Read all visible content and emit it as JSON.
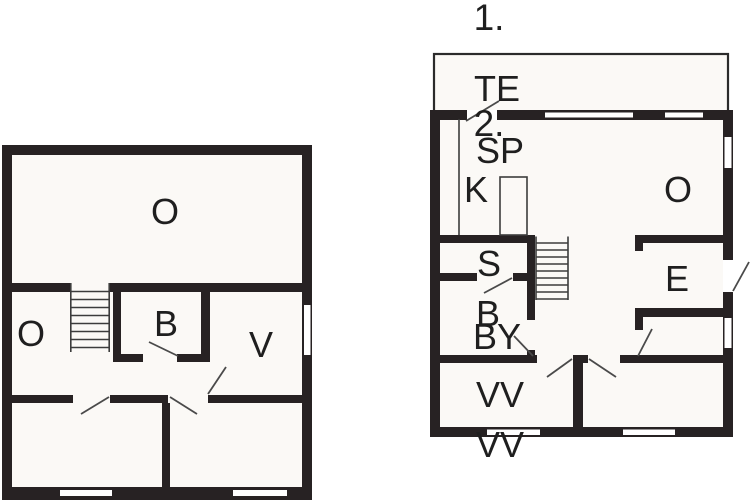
{
  "titles": {
    "floor_one": "1.",
    "floor_two": "2."
  },
  "upper_plan": {
    "rooms": {
      "o_main": "O",
      "o_side": "O",
      "b": "B",
      "v": "V"
    }
  },
  "ground_plan": {
    "rooms": {
      "terrace": "TE",
      "sp": "SP",
      "k": "K",
      "o": "O",
      "s": "S",
      "e": "E",
      "b": "B",
      "by": "BY",
      "vv": "VV",
      "vv_outside": "VV"
    }
  },
  "colors": {
    "wall": "#272223",
    "floor": "#fbf9f6",
    "thin_line": "#3c3c3c",
    "text": "#1f1f1f",
    "background": "#ffffff"
  }
}
